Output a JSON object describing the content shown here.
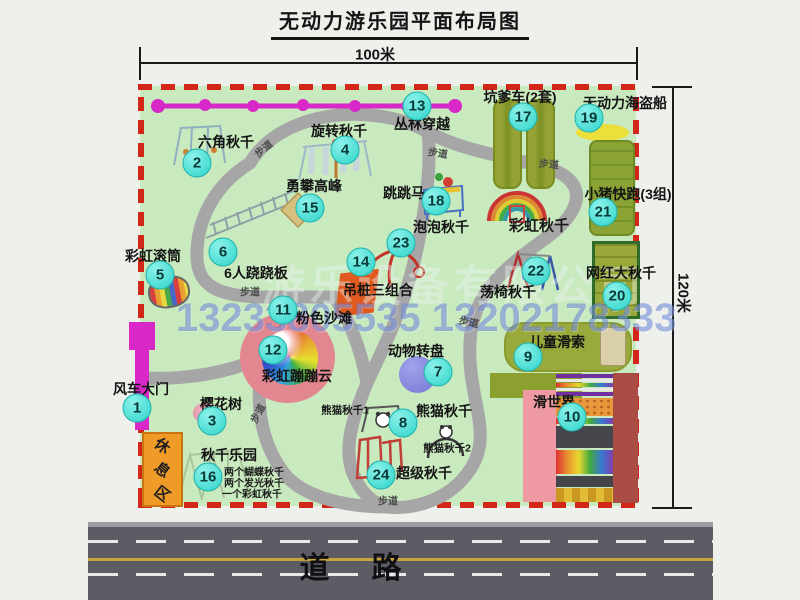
{
  "title": "无动力游乐园平面布局图",
  "dimensions": {
    "width_label": "100米",
    "height_label": "120米"
  },
  "road": {
    "label": "道路"
  },
  "rest_area": {
    "label": "休息区"
  },
  "watermark": {
    "company": "游乐设备有限公司",
    "phone": "13233805535 13202178333"
  },
  "walkway_label_text": "步道",
  "walkway_label_positions": [
    {
      "x": 263,
      "y": 148,
      "rot": -40
    },
    {
      "x": 438,
      "y": 152,
      "rot": 8
    },
    {
      "x": 549,
      "y": 163,
      "rot": 5
    },
    {
      "x": 250,
      "y": 291,
      "rot": 0
    },
    {
      "x": 257,
      "y": 413,
      "rot": -62
    },
    {
      "x": 469,
      "y": 321,
      "rot": 12
    },
    {
      "x": 388,
      "y": 500,
      "rot": 0
    }
  ],
  "attractions": [
    {
      "num": "1",
      "label": "风车大门",
      "bx": 137,
      "by": 408,
      "lx": 141,
      "ly": 389
    },
    {
      "num": "2",
      "label": "六角秋千",
      "bx": 197,
      "by": 163,
      "lx": 226,
      "ly": 142
    },
    {
      "num": "3",
      "label": "樱花树",
      "bx": 212,
      "by": 421,
      "lx": 221,
      "ly": 404
    },
    {
      "num": "4",
      "label": "旋转秋千",
      "bx": 345,
      "by": 150,
      "lx": 339,
      "ly": 131
    },
    {
      "num": "5",
      "label": "彩虹滚筒",
      "bx": 160,
      "by": 275,
      "lx": 153,
      "ly": 256
    },
    {
      "num": "6",
      "label": "6人跷跷板",
      "bx": 223,
      "by": 252,
      "lx": 256,
      "ly": 273
    },
    {
      "num": "7",
      "label": "动物转盘",
      "bx": 438,
      "by": 372,
      "lx": 416,
      "ly": 351
    },
    {
      "num": "8",
      "label": "熊猫秋千",
      "bx": 403,
      "by": 423,
      "lx": 444,
      "ly": 411
    },
    {
      "num": "9",
      "label": "儿童滑索",
      "bx": 528,
      "by": 357,
      "lx": 557,
      "ly": 342
    },
    {
      "num": "10",
      "label": "滑世界",
      "bx": 572,
      "by": 417,
      "lx": 554,
      "ly": 402
    },
    {
      "num": "11",
      "label": "粉色沙滩",
      "bx": 283,
      "by": 310,
      "lx": 324,
      "ly": 318
    },
    {
      "num": "12",
      "label": "彩虹蹦蹦云",
      "bx": 273,
      "by": 350,
      "lx": 297,
      "ly": 376
    },
    {
      "num": "13",
      "label": "丛林穿越",
      "bx": 417,
      "by": 106,
      "lx": 422,
      "ly": 124
    },
    {
      "num": "14",
      "label": "吊桩三组合",
      "bx": 361,
      "by": 262,
      "lx": 378,
      "ly": 290
    },
    {
      "num": "15",
      "label": "勇攀高峰",
      "bx": 310,
      "by": 208,
      "lx": 314,
      "ly": 186
    },
    {
      "num": "16",
      "label": "秋千乐园",
      "bx": 208,
      "by": 477,
      "lx": 229,
      "ly": 455
    },
    {
      "num": "17",
      "label": "坑爹车(2套)",
      "bx": 523,
      "by": 117,
      "lx": 520,
      "ly": 97
    },
    {
      "num": "18",
      "label": "跳跳马",
      "bx": 436,
      "by": 201,
      "lx": 404,
      "ly": 193
    },
    {
      "num": "19",
      "label": "无动力海盗船",
      "bx": 589,
      "by": 118,
      "lx": 625,
      "ly": 103
    },
    {
      "num": "20",
      "label": "网红大秋千",
      "bx": 617,
      "by": 296,
      "lx": 621,
      "ly": 273
    },
    {
      "num": "21",
      "label": "小猪快跑(3组)",
      "bx": 603,
      "by": 212,
      "lx": 628,
      "ly": 194
    },
    {
      "num": "22",
      "label": "荡椅秋千",
      "bx": 536,
      "by": 271,
      "lx": 508,
      "ly": 292
    },
    {
      "num": "23",
      "label": "泡泡秋千",
      "bx": 401,
      "by": 243,
      "lx": 441,
      "ly": 227
    },
    {
      "num": "24",
      "label": "超级秋千",
      "bx": 381,
      "by": 475,
      "lx": 424,
      "ly": 473
    }
  ],
  "extra_labels": [
    {
      "text": "彩虹秋千",
      "x": 539,
      "y": 225,
      "fs": 15
    },
    {
      "text": "熊猫秋千1",
      "x": 345,
      "y": 410,
      "fs": 10.5
    },
    {
      "text": "熊猫秋千2",
      "x": 447,
      "y": 448,
      "fs": 10.5
    },
    {
      "text": "两个蝴蝶秋千",
      "x": 254,
      "y": 471,
      "fs": 10
    },
    {
      "text": "两个发光秋千",
      "x": 254,
      "y": 482,
      "fs": 10
    },
    {
      "text": "一个彩虹秋千",
      "x": 252,
      "y": 493,
      "fs": 10
    }
  ],
  "colors": {
    "map_green": "#c9e9bf",
    "border_red": "#d22618",
    "badge_cyan": "#2ed3c9",
    "zipline_magenta": "#d828c8",
    "road_gray": "#5d5c64"
  }
}
